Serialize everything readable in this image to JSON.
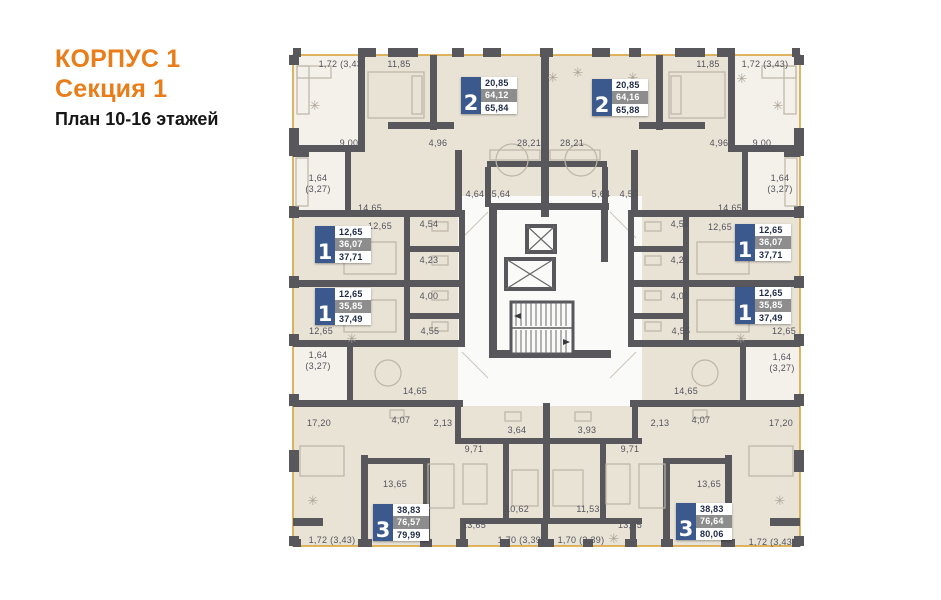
{
  "title": {
    "building": "КОРПУС 1",
    "section": "Секция 1",
    "floors": "План 10-16 этажей"
  },
  "colors": {
    "accent_orange": "#E87D1A",
    "plan_outline_orange": "#D9A33C",
    "wall_gray": "#57575C",
    "floor_beige": "#E9E3D6",
    "loggia_light": "#F4F1EA",
    "core_white": "#FAFAF8",
    "badge_blue": "#3C598E",
    "badge_gray": "#8D8D8D",
    "badge_text_dark": "#1E2A45",
    "label_text": "#52525C"
  },
  "apartments": [
    {
      "rooms": "2",
      "area_living": "20,85",
      "area_mid": "64,12",
      "area_total": "65,84"
    },
    {
      "rooms": "2",
      "area_living": "20,85",
      "area_mid": "64,16",
      "area_total": "65,88"
    },
    {
      "rooms": "1",
      "area_living": "12,65",
      "area_mid": "36,07",
      "area_total": "37,71"
    },
    {
      "rooms": "1",
      "area_living": "12,65",
      "area_mid": "35,85",
      "area_total": "37,49"
    },
    {
      "rooms": "1",
      "area_living": "12,65",
      "area_mid": "36,07",
      "area_total": "37,71"
    },
    {
      "rooms": "1",
      "area_living": "12,65",
      "area_mid": "35,85",
      "area_total": "37,49"
    },
    {
      "rooms": "3",
      "area_living": "38,83",
      "area_mid": "76,57",
      "area_total": "79,99"
    },
    {
      "rooms": "3",
      "area_living": "38,83",
      "area_mid": "76,64",
      "area_total": "80,06"
    }
  ],
  "room_labels": [
    {
      "t": "1,72 (3,43)",
      "x": 342,
      "y": 64
    },
    {
      "t": "11,85",
      "x": 399,
      "y": 64
    },
    {
      "t": "11,85",
      "x": 708,
      "y": 64
    },
    {
      "t": "1,72 (3,43)",
      "x": 765,
      "y": 64
    },
    {
      "t": "9,00",
      "x": 349,
      "y": 143
    },
    {
      "t": "4,96",
      "x": 438,
      "y": 143
    },
    {
      "t": "28,21",
      "x": 529,
      "y": 143
    },
    {
      "t": "28,21",
      "x": 572,
      "y": 143
    },
    {
      "t": "4,96",
      "x": 719,
      "y": 143
    },
    {
      "t": "9,00",
      "x": 762,
      "y": 143
    },
    {
      "t": "1,64",
      "x": 318,
      "y": 178
    },
    {
      "t": "(3,27)",
      "x": 318,
      "y": 189
    },
    {
      "t": "1,64",
      "x": 780,
      "y": 178
    },
    {
      "t": "(3,27)",
      "x": 780,
      "y": 189
    },
    {
      "t": "14,65",
      "x": 370,
      "y": 208
    },
    {
      "t": "14,65",
      "x": 730,
      "y": 208
    },
    {
      "t": "4,64",
      "x": 475,
      "y": 194
    },
    {
      "t": "5,64",
      "x": 501,
      "y": 194
    },
    {
      "t": "5,64",
      "x": 601,
      "y": 194
    },
    {
      "t": "4,50",
      "x": 629,
      "y": 194
    },
    {
      "t": "12,65",
      "x": 380,
      "y": 226
    },
    {
      "t": "4,54",
      "x": 429,
      "y": 224
    },
    {
      "t": "4,54",
      "x": 680,
      "y": 224
    },
    {
      "t": "12,65",
      "x": 720,
      "y": 227
    },
    {
      "t": "4,23",
      "x": 429,
      "y": 260
    },
    {
      "t": "4,23",
      "x": 680,
      "y": 260
    },
    {
      "t": "4,00",
      "x": 429,
      "y": 296
    },
    {
      "t": "4,00",
      "x": 680,
      "y": 296
    },
    {
      "t": "4,55",
      "x": 430,
      "y": 331
    },
    {
      "t": "12,65",
      "x": 321,
      "y": 331
    },
    {
      "t": "4,55",
      "x": 681,
      "y": 331
    },
    {
      "t": "12,65",
      "x": 784,
      "y": 331
    },
    {
      "t": "1,64",
      "x": 318,
      "y": 355
    },
    {
      "t": "(3,27)",
      "x": 318,
      "y": 366
    },
    {
      "t": "1,64",
      "x": 782,
      "y": 357
    },
    {
      "t": "(3,27)",
      "x": 782,
      "y": 368
    },
    {
      "t": "14,65",
      "x": 415,
      "y": 391
    },
    {
      "t": "14,65",
      "x": 686,
      "y": 391
    },
    {
      "t": "17,20",
      "x": 319,
      "y": 423
    },
    {
      "t": "4,07",
      "x": 401,
      "y": 420
    },
    {
      "t": "2,13",
      "x": 443,
      "y": 423
    },
    {
      "t": "2,13",
      "x": 660,
      "y": 423
    },
    {
      "t": "4,07",
      "x": 701,
      "y": 420
    },
    {
      "t": "17,20",
      "x": 781,
      "y": 423
    },
    {
      "t": "3,64",
      "x": 517,
      "y": 430
    },
    {
      "t": "3,93",
      "x": 587,
      "y": 430
    },
    {
      "t": "9,71",
      "x": 474,
      "y": 449
    },
    {
      "t": "9,71",
      "x": 630,
      "y": 449
    },
    {
      "t": "13,65",
      "x": 395,
      "y": 484
    },
    {
      "t": "13,65",
      "x": 709,
      "y": 484
    },
    {
      "t": "10,62",
      "x": 517,
      "y": 509
    },
    {
      "t": "11,53",
      "x": 588,
      "y": 509
    },
    {
      "t": "13,65",
      "x": 474,
      "y": 525
    },
    {
      "t": "13,65",
      "x": 630,
      "y": 525
    },
    {
      "t": "1,72 (3,43)",
      "x": 332,
      "y": 540
    },
    {
      "t": "1,70 (3,39)",
      "x": 521,
      "y": 540
    },
    {
      "t": "1,70 (3,39)",
      "x": 581,
      "y": 540
    },
    {
      "t": "1,72 (3,43)",
      "x": 772,
      "y": 542
    }
  ]
}
